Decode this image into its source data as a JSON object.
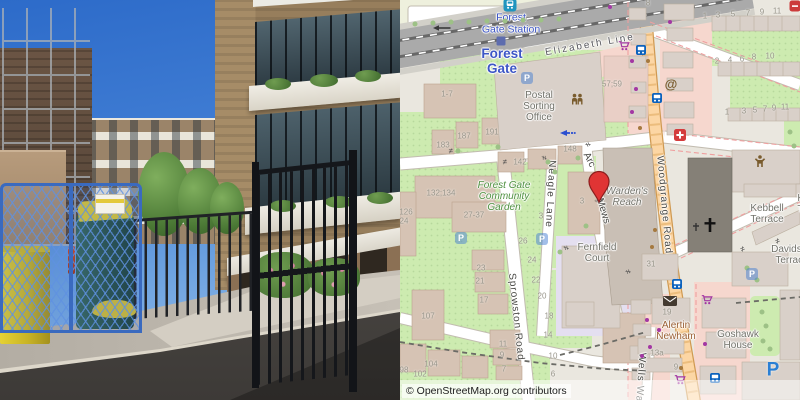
{
  "map": {
    "attribution": "© OpenStreetMap.org contributors",
    "colors": {
      "primary_road": "#fcd6a4",
      "green_area": "#cdebb0",
      "retail_pink": "#f6d7ce",
      "building": "#d9d0c9",
      "marker_red": "#e03434",
      "station_blue": "#3d56c6",
      "railway_gray": "#aaaaaa",
      "lavender_block": "#e4dff0"
    },
    "marker": {
      "x": 199,
      "y": 202,
      "label": "dropped-pin"
    },
    "street_labels": [
      {
        "text": "Elizabeth Line",
        "x": 190,
        "y": 45,
        "rot": -10,
        "cls": "rail-label"
      },
      {
        "text": "Woodgrange Road",
        "x": 264,
        "y": 205,
        "rot": 85,
        "ls": 1
      },
      {
        "text": "Neagle Lane",
        "x": 150,
        "y": 194,
        "rot": 93,
        "ls": 1
      },
      {
        "text": "Sprowston Road",
        "x": 116,
        "y": 317,
        "rot": 84,
        "ls": 1
      },
      {
        "text": "Wells Walk",
        "x": 240,
        "y": 382,
        "rot": 94,
        "ls": 1
      },
      {
        "text": "Arc",
        "x": 189,
        "y": 160,
        "rot": 62
      },
      {
        "text": "Mews",
        "x": 203,
        "y": 211,
        "rot": 73
      }
    ],
    "area_labels": [
      {
        "lines": [
          "Forest",
          "Gate Station"
        ],
        "x": 111,
        "y": 24,
        "cls": "station-label",
        "name": "station-name-label"
      },
      {
        "lines": [
          "Forest",
          "Gate"
        ],
        "x": 102,
        "y": 61,
        "cls": "place-label",
        "name": "place-name-label"
      },
      {
        "lines": [
          "Postal",
          "Sorting",
          "Office"
        ],
        "x": 139,
        "y": 107,
        "cls": "building-label",
        "name": "postal-sorting-office-label"
      },
      {
        "lines": [
          "Forest Gate",
          "Community",
          "Garden"
        ],
        "x": 104,
        "y": 197,
        "cls": "garden-label",
        "name": "community-garden-label"
      },
      {
        "lines": [
          "Warden's",
          "Reach"
        ],
        "x": 227,
        "y": 197,
        "cls": "building-label italic",
        "name": "wardens-reach-label"
      },
      {
        "lines": [
          "Fernfield",
          "Court"
        ],
        "x": 197,
        "y": 253,
        "cls": "building-label",
        "name": "fernfield-court-label"
      },
      {
        "lines": [
          "Kebbell",
          "Terrace"
        ],
        "x": 367,
        "y": 214,
        "cls": "building-label",
        "name": "kebbell-terrace-label"
      },
      {
        "lines": [
          "Kebbell",
          "Terrace"
        ],
        "x": 414,
        "y": 204,
        "cls": "building-label",
        "name": "kebbell-terrace-label-2"
      },
      {
        "lines": [
          "Davidson",
          "Terrace"
        ],
        "x": 392,
        "y": 255,
        "cls": "building-label",
        "name": "davidson-terrace-label"
      },
      {
        "lines": [
          "Goshawk",
          "House"
        ],
        "x": 338,
        "y": 340,
        "cls": "building-label",
        "name": "goshawk-house-label"
      },
      {
        "lines": [
          "Alertin",
          "Newham"
        ],
        "x": 276,
        "y": 331,
        "cls": "amenity-label",
        "name": "alertin-newham-label"
      }
    ],
    "house_numbers": [
      {
        "t": "1-7",
        "x": 47,
        "y": 95
      },
      {
        "t": "183",
        "x": 43,
        "y": 146
      },
      {
        "t": "187",
        "x": 64,
        "y": 137
      },
      {
        "t": "191",
        "x": 92,
        "y": 133
      },
      {
        "t": "57;59",
        "x": 212,
        "y": 85
      },
      {
        "t": "8",
        "x": 248,
        "y": 4
      },
      {
        "t": "1",
        "x": 305,
        "y": 17
      },
      {
        "t": "3",
        "x": 318,
        "y": 16
      },
      {
        "t": "5",
        "x": 333,
        "y": 15
      },
      {
        "t": "7",
        "x": 348,
        "y": 14
      },
      {
        "t": "9",
        "x": 362,
        "y": 13
      },
      {
        "t": "11",
        "x": 377,
        "y": 12
      },
      {
        "t": "2",
        "x": 317,
        "y": 62
      },
      {
        "t": "4",
        "x": 330,
        "y": 61
      },
      {
        "t": "6",
        "x": 342,
        "y": 60
      },
      {
        "t": "8",
        "x": 354,
        "y": 58
      },
      {
        "t": "10",
        "x": 370,
        "y": 57
      },
      {
        "t": "1",
        "x": 327,
        "y": 113
      },
      {
        "t": "3",
        "x": 344,
        "y": 112
      },
      {
        "t": "5",
        "x": 355,
        "y": 111
      },
      {
        "t": "7",
        "x": 365,
        "y": 110
      },
      {
        "t": "9",
        "x": 374,
        "y": 109
      },
      {
        "t": "11",
        "x": 385,
        "y": 108
      },
      {
        "t": "142",
        "x": 120,
        "y": 163
      },
      {
        "t": "148",
        "x": 170,
        "y": 150
      },
      {
        "t": "132;134",
        "x": 41,
        "y": 194
      },
      {
        "t": "126",
        "x": 6,
        "y": 213
      },
      {
        "t": "24",
        "x": 4,
        "y": 222
      },
      {
        "t": "27-37",
        "x": 74,
        "y": 216
      },
      {
        "t": "3",
        "x": 182,
        "y": 202
      },
      {
        "t": "3",
        "x": 141,
        "y": 217
      },
      {
        "t": "26",
        "x": 123,
        "y": 242
      },
      {
        "t": "24",
        "x": 132,
        "y": 261
      },
      {
        "t": "23",
        "x": 81,
        "y": 269
      },
      {
        "t": "22",
        "x": 136,
        "y": 281
      },
      {
        "t": "21",
        "x": 80,
        "y": 282
      },
      {
        "t": "20",
        "x": 142,
        "y": 297
      },
      {
        "t": "17",
        "x": 84,
        "y": 301
      },
      {
        "t": "18",
        "x": 149,
        "y": 317
      },
      {
        "t": "14",
        "x": 148,
        "y": 336
      },
      {
        "t": "107",
        "x": 28,
        "y": 317
      },
      {
        "t": "11",
        "x": 103,
        "y": 345
      },
      {
        "t": "9",
        "x": 102,
        "y": 356
      },
      {
        "t": "10",
        "x": 153,
        "y": 357
      },
      {
        "t": "104",
        "x": 31,
        "y": 365
      },
      {
        "t": "7",
        "x": 104,
        "y": 370
      },
      {
        "t": "102",
        "x": 20,
        "y": 375
      },
      {
        "t": "98",
        "x": 4,
        "y": 371
      },
      {
        "t": "6",
        "x": 153,
        "y": 375
      },
      {
        "t": "31",
        "x": 251,
        "y": 265
      },
      {
        "t": "19",
        "x": 267,
        "y": 313
      },
      {
        "t": "13a",
        "x": 257,
        "y": 354
      },
      {
        "t": "9",
        "x": 276,
        "y": 368
      }
    ],
    "icons": [
      {
        "type": "train",
        "name": "railway-station-icon",
        "x": 110,
        "y": 5
      },
      {
        "type": "stationsq",
        "name": "station-building-icon",
        "x": 101,
        "y": 41
      },
      {
        "type": "bus",
        "name": "bus-stop-icon",
        "x": 241,
        "y": 50
      },
      {
        "type": "bus",
        "name": "bus-stop-icon",
        "x": 257,
        "y": 98
      },
      {
        "type": "bus",
        "name": "bus-stop-icon",
        "x": 277,
        "y": 284
      },
      {
        "type": "bus",
        "name": "bus-stop-icon",
        "x": 315,
        "y": 378
      },
      {
        "type": "cart",
        "name": "supermarket-icon",
        "x": 224,
        "y": 46
      },
      {
        "type": "cart",
        "name": "supermarket-icon",
        "x": 307,
        "y": 300
      },
      {
        "type": "cart",
        "name": "supermarket-icon",
        "x": 280,
        "y": 380
      },
      {
        "type": "at",
        "name": "internet-cafe-icon",
        "x": 271,
        "y": 84
      },
      {
        "type": "firstaid",
        "name": "clinic-icon",
        "x": 280,
        "y": 135
      },
      {
        "type": "people",
        "name": "community-icon",
        "x": 177,
        "y": 99
      },
      {
        "type": "person",
        "name": "community-centre-icon",
        "x": 360,
        "y": 161
      },
      {
        "type": "cross",
        "name": "church-cross-icon",
        "x": 310,
        "y": 225
      },
      {
        "type": "crosssm",
        "name": "memorial-cross-icon",
        "x": 296,
        "y": 227
      },
      {
        "type": "envelope",
        "name": "post-office-icon",
        "x": 270,
        "y": 301
      },
      {
        "type": "pbig",
        "name": "parking-icon",
        "x": 373,
        "y": 370
      },
      {
        "type": "pfade",
        "name": "parking-icon",
        "x": 352,
        "y": 274
      },
      {
        "type": "pfade",
        "name": "parking-icon",
        "x": 127,
        "y": 78
      },
      {
        "type": "pfade",
        "name": "parking-icon",
        "x": 61,
        "y": 238
      },
      {
        "type": "pfade",
        "name": "parking-icon",
        "x": 142,
        "y": 239
      },
      {
        "type": "oneway",
        "name": "oneway-arrow-icon",
        "x": 168,
        "y": 133
      },
      {
        "type": "onewayk",
        "name": "oneway-arrow-icon",
        "x": 42,
        "y": 28
      },
      {
        "type": "redpoi",
        "name": "poi-icon",
        "x": 395,
        "y": 6
      }
    ],
    "gates": [
      [
        51,
        152,
        0
      ],
      [
        105,
        163,
        0
      ],
      [
        187,
        145,
        60
      ],
      [
        143,
        158,
        90
      ],
      [
        165,
        248,
        80
      ],
      [
        227,
        272,
        70
      ],
      [
        343,
        250,
        -25
      ],
      [
        378,
        242,
        -25
      ]
    ],
    "dots": {
      "trees": [
        [
          15,
          24
        ],
        [
          33,
          23
        ],
        [
          51,
          22
        ],
        [
          69,
          22
        ],
        [
          87,
          21
        ],
        [
          105,
          21
        ],
        [
          123,
          20
        ],
        [
          141,
          20
        ],
        [
          159,
          19
        ],
        [
          58,
          151
        ],
        [
          98,
          147
        ],
        [
          148,
          162
        ],
        [
          178,
          158
        ],
        [
          155,
          172
        ],
        [
          186,
          226
        ],
        [
          160,
          252
        ],
        [
          362,
          312
        ],
        [
          366,
          326
        ],
        [
          363,
          341
        ],
        [
          370,
          349
        ],
        [
          347,
          268
        ],
        [
          357,
          280
        ],
        [
          390,
          132
        ],
        [
          394,
          146
        ]
      ],
      "shops": [
        [
          210,
          7
        ],
        [
          270,
          22
        ],
        [
          232,
          61
        ],
        [
          236,
          89
        ],
        [
          232,
          112
        ],
        [
          259,
          330
        ],
        [
          250,
          347
        ],
        [
          242,
          356
        ],
        [
          305,
          344
        ],
        [
          247,
          320
        ]
      ],
      "pois": [
        [
          255,
          230
        ],
        [
          252,
          247
        ],
        [
          248,
          61
        ],
        [
          281,
          368
        ],
        [
          240,
          128
        ]
      ]
    }
  },
  "photo": {
    "palette": {
      "sky_blue": "#3f7cd3",
      "brick_tan": "#977e5c",
      "dark_brick": "#5d4b3e",
      "heras_fence_blue": "#3a6abf",
      "bin_yellow": "#d4c22a",
      "bin_green": "#275046",
      "gate_black": "#15171b",
      "concrete": "#c6c0b6",
      "asphalt": "#4a4744"
    }
  }
}
